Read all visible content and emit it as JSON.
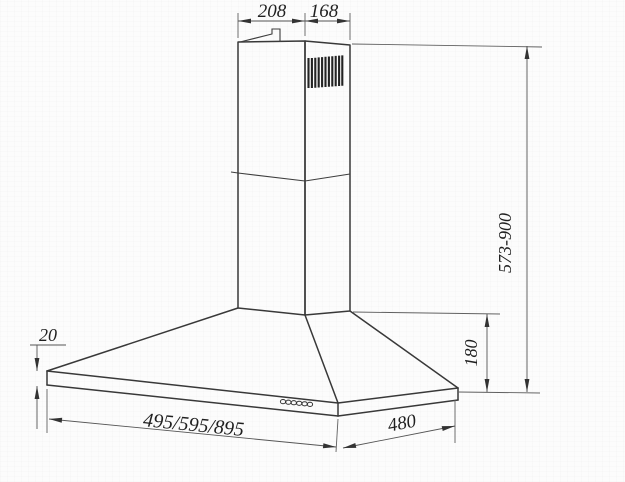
{
  "drawing": {
    "background_color": "#fcfcfc",
    "line_color": "#383838",
    "dimension_line_color": "#555555",
    "text_color": "#1f1f1f",
    "dimensions": {
      "chimney_top_width": "208",
      "chimney_top_depth": "168",
      "overall_height_range": "573-900",
      "canopy_height": "180",
      "rim_thickness": "20",
      "hood_width_options": "495/595/895",
      "hood_depth": "480"
    },
    "features": {
      "vent_grille_slats": 11,
      "control_buttons": 6
    }
  }
}
